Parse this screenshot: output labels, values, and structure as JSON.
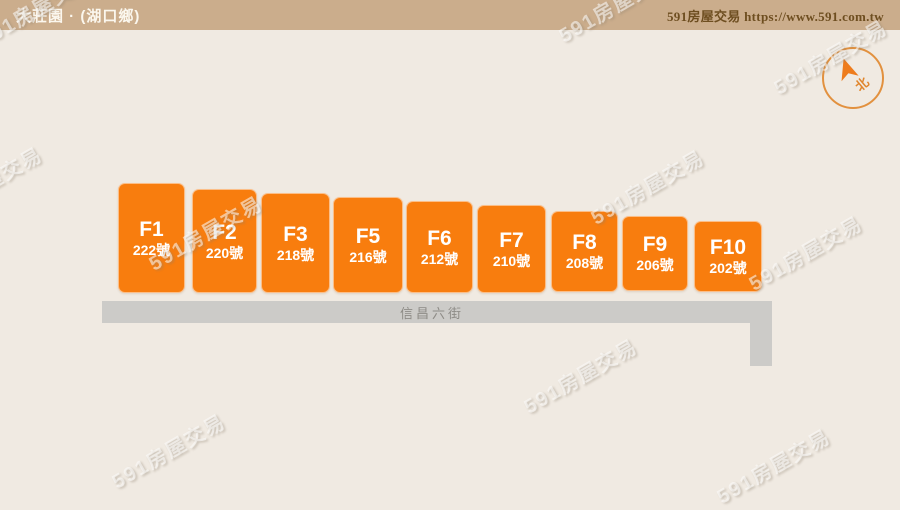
{
  "header": {
    "title": "大莊園 · (湖口鄉)",
    "brand": "591房屋交易 https://www.591.com.tw"
  },
  "compass": {
    "north_label": "北"
  },
  "road": {
    "name": "信昌六街"
  },
  "buildings": [
    {
      "id": "F1",
      "address": "222號",
      "x": 118,
      "y": 183,
      "w": 67,
      "h": 110
    },
    {
      "id": "F2",
      "address": "220號",
      "x": 192,
      "y": 189,
      "w": 65,
      "h": 104
    },
    {
      "id": "F3",
      "address": "218號",
      "x": 261,
      "y": 193,
      "w": 69,
      "h": 100
    },
    {
      "id": "F5",
      "address": "216號",
      "x": 333,
      "y": 197,
      "w": 70,
      "h": 96
    },
    {
      "id": "F6",
      "address": "212號",
      "x": 406,
      "y": 201,
      "w": 67,
      "h": 92
    },
    {
      "id": "F7",
      "address": "210號",
      "x": 477,
      "y": 205,
      "w": 69,
      "h": 88
    },
    {
      "id": "F8",
      "address": "208號",
      "x": 551,
      "y": 211,
      "w": 67,
      "h": 81
    },
    {
      "id": "F9",
      "address": "206號",
      "x": 622,
      "y": 216,
      "w": 66,
      "h": 75
    },
    {
      "id": "F10",
      "address": "202號",
      "x": 694,
      "y": 221,
      "w": 68,
      "h": 71
    }
  ],
  "watermark": {
    "text": "591房屋交易",
    "positions": [
      {
        "x": -15,
        "y": 183
      },
      {
        "x": 35,
        "y": 8
      },
      {
        "x": 615,
        "y": 4
      },
      {
        "x": 830,
        "y": 56
      },
      {
        "x": 205,
        "y": 232
      },
      {
        "x": 647,
        "y": 186
      },
      {
        "x": 805,
        "y": 252
      },
      {
        "x": 580,
        "y": 375
      },
      {
        "x": 168,
        "y": 450
      },
      {
        "x": 773,
        "y": 465
      }
    ]
  },
  "colors": {
    "page_bg": "#f0eae2",
    "header_bg": "#cbad8c",
    "building": "#f87d0e",
    "road": "#cccbc8",
    "compass_ring": "#e2913f"
  }
}
